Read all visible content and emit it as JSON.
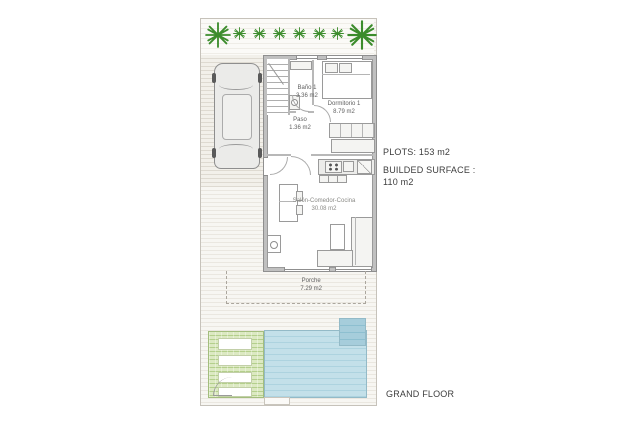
{
  "plan": {
    "rooms": [
      {
        "name": "Baño 1",
        "area": "3.36 m2"
      },
      {
        "name": "Dormitorio 1",
        "area": "8.79 m2"
      },
      {
        "name": "Paso",
        "area": "1.36 m2"
      },
      {
        "name": "Salón-Comedor-Cocina",
        "area": "30.08 m2"
      },
      {
        "name": "Porche",
        "area": "7.29 m2"
      }
    ],
    "annotations": {
      "plots": "PLOTS: 153 m2",
      "built_surface_line1": "BUILDED SURFACE :",
      "built_surface_line2": "110 m2",
      "floor_name": "GRAND FLOOR"
    },
    "palms": {
      "color": "#3c8c2c",
      "items": [
        {
          "x": 4,
          "y": 3,
          "size": 26
        },
        {
          "x": 32,
          "y": 8,
          "size": 13
        },
        {
          "x": 52,
          "y": 8,
          "size": 13
        },
        {
          "x": 72,
          "y": 8,
          "size": 13
        },
        {
          "x": 92,
          "y": 8,
          "size": 13
        },
        {
          "x": 112,
          "y": 8,
          "size": 13
        },
        {
          "x": 130,
          "y": 8,
          "size": 13
        },
        {
          "x": 146,
          "y": 1,
          "size": 30
        }
      ]
    },
    "colors": {
      "pool": "#b9dbe6",
      "grass": "#c4d8a0",
      "paving_line": "#eae7e0",
      "wall": "#bdbdbd",
      "palm_green": "#3c8c2c"
    }
  }
}
